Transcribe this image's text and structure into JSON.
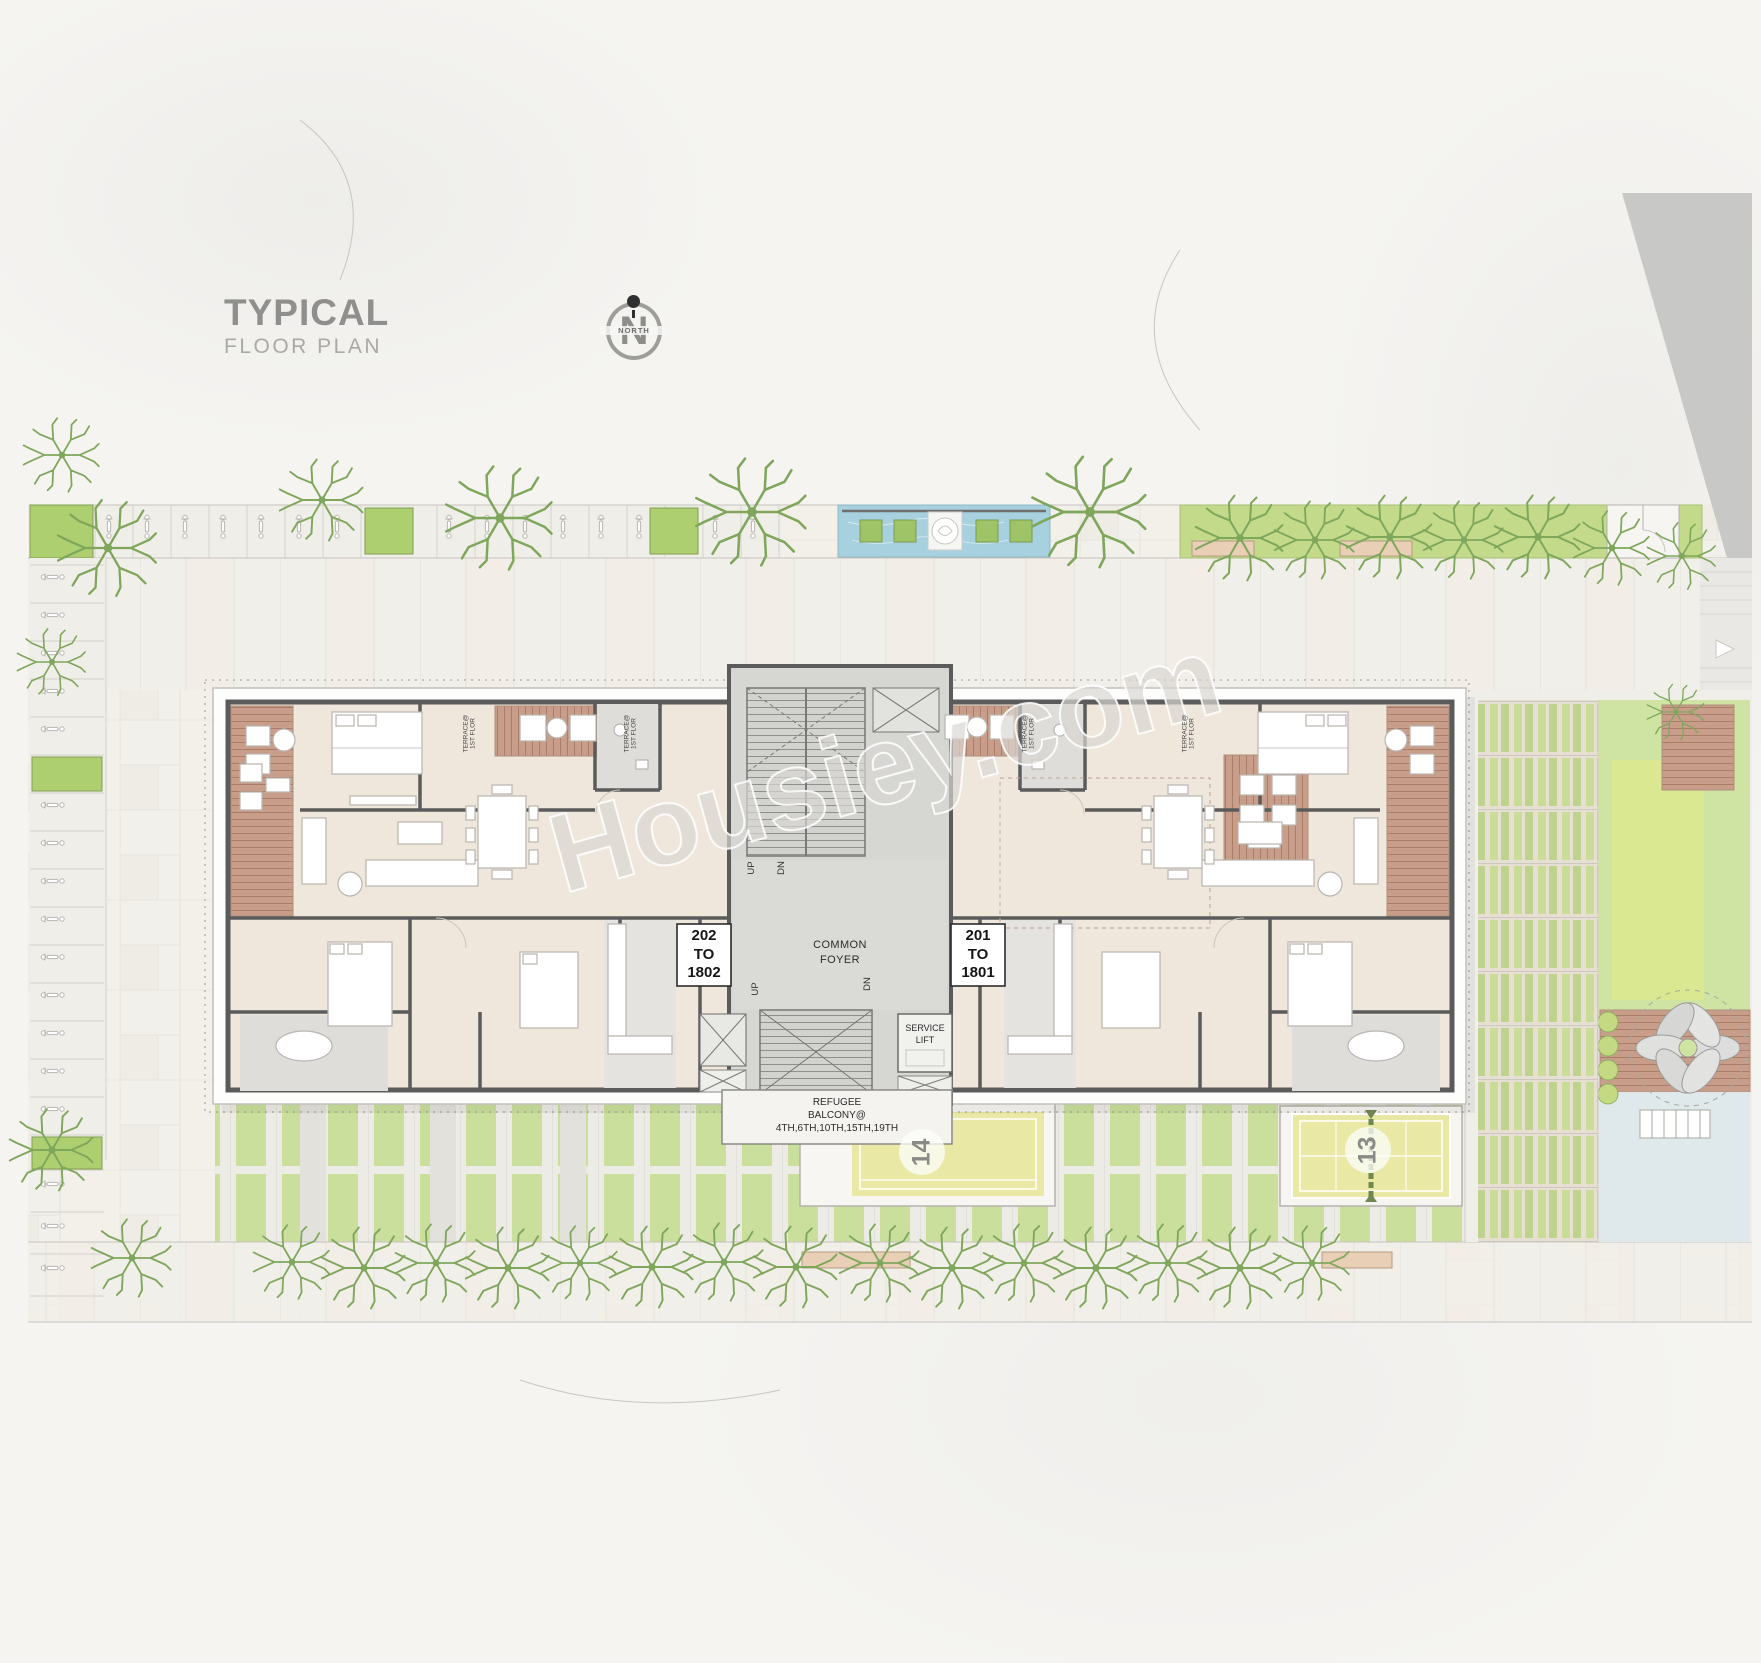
{
  "header": {
    "title": "TYPICAL",
    "subtitle": "FLOOR PLAN"
  },
  "north_badge": {
    "letter": "N",
    "label": "NORTH"
  },
  "watermark": {
    "text": "Housiey.com"
  },
  "building": {
    "unit_left": {
      "number": "202",
      "to": "TO",
      "top_floor": "1802"
    },
    "unit_right": {
      "number": "201",
      "to": "TO",
      "top_floor": "1801"
    },
    "common_foyer": {
      "line1": "COMMON",
      "line2": "FOYER"
    },
    "service_lift": {
      "line1": "SERVICE",
      "line2": "LIFT"
    },
    "refugee_balcony": {
      "line1": "REFUGEE",
      "line2": "BALCONY@",
      "line3": "4TH,6TH,10TH,15TH,19TH"
    },
    "stairs": {
      "up": "UP",
      "down": "DN"
    },
    "terrace_label": {
      "line1": "TERRACE@",
      "line2": "1ST FLOR"
    }
  },
  "site": {
    "court_left_number": "14",
    "court_right_number": "13"
  },
  "colors": {
    "wall": "#5b5b5b",
    "room": "#efe6dc",
    "core": "#d6d6d3",
    "bath": "#deddd9",
    "deck": "#c89e8b",
    "tree": "#7ea75c",
    "lawn": "#cfe3a2",
    "court": "#e9e8a4",
    "water": "#a7d1df",
    "hedge": "#cadf9b",
    "outsite": "#c8c8c6",
    "page": "#f5f4f1"
  }
}
